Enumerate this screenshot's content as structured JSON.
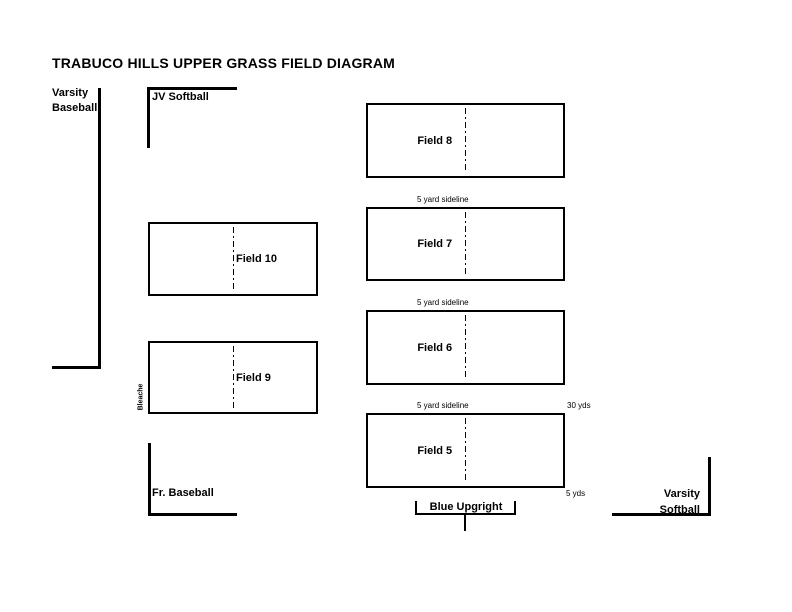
{
  "diagram": {
    "title": "TRABUCO HILLS UPPER GRASS FIELD DIAGRAM"
  },
  "areas": {
    "varsity_baseball": {
      "line1": "Varsity",
      "line2": "Baseball"
    },
    "jv_softball": {
      "label": "JV Softball"
    },
    "fr_baseball": {
      "label": "Fr. Baseball"
    },
    "varsity_softball": {
      "line1": "Varsity",
      "line2": "Softball"
    },
    "blue_upright": {
      "label": "Blue Upgright"
    },
    "bleachers": {
      "label": "Bleache"
    }
  },
  "fields": {
    "field8": {
      "label": "Field 8"
    },
    "field7": {
      "label": "Field 7"
    },
    "field6": {
      "label": "Field 6"
    },
    "field5": {
      "label": "Field 5"
    },
    "field10": {
      "label": "Field 10"
    },
    "field9": {
      "label": "Field 9"
    }
  },
  "annotations": {
    "sideline_above_field7": "5 yard sideline",
    "sideline_above_field6": "5 yard sideline",
    "sideline_above_field5": "5 yard sideline",
    "field_width": "30 yds",
    "sideline_offset": "5 yds"
  },
  "colors": {
    "line": "#000000",
    "background": "#ffffff",
    "text": "#000000"
  }
}
